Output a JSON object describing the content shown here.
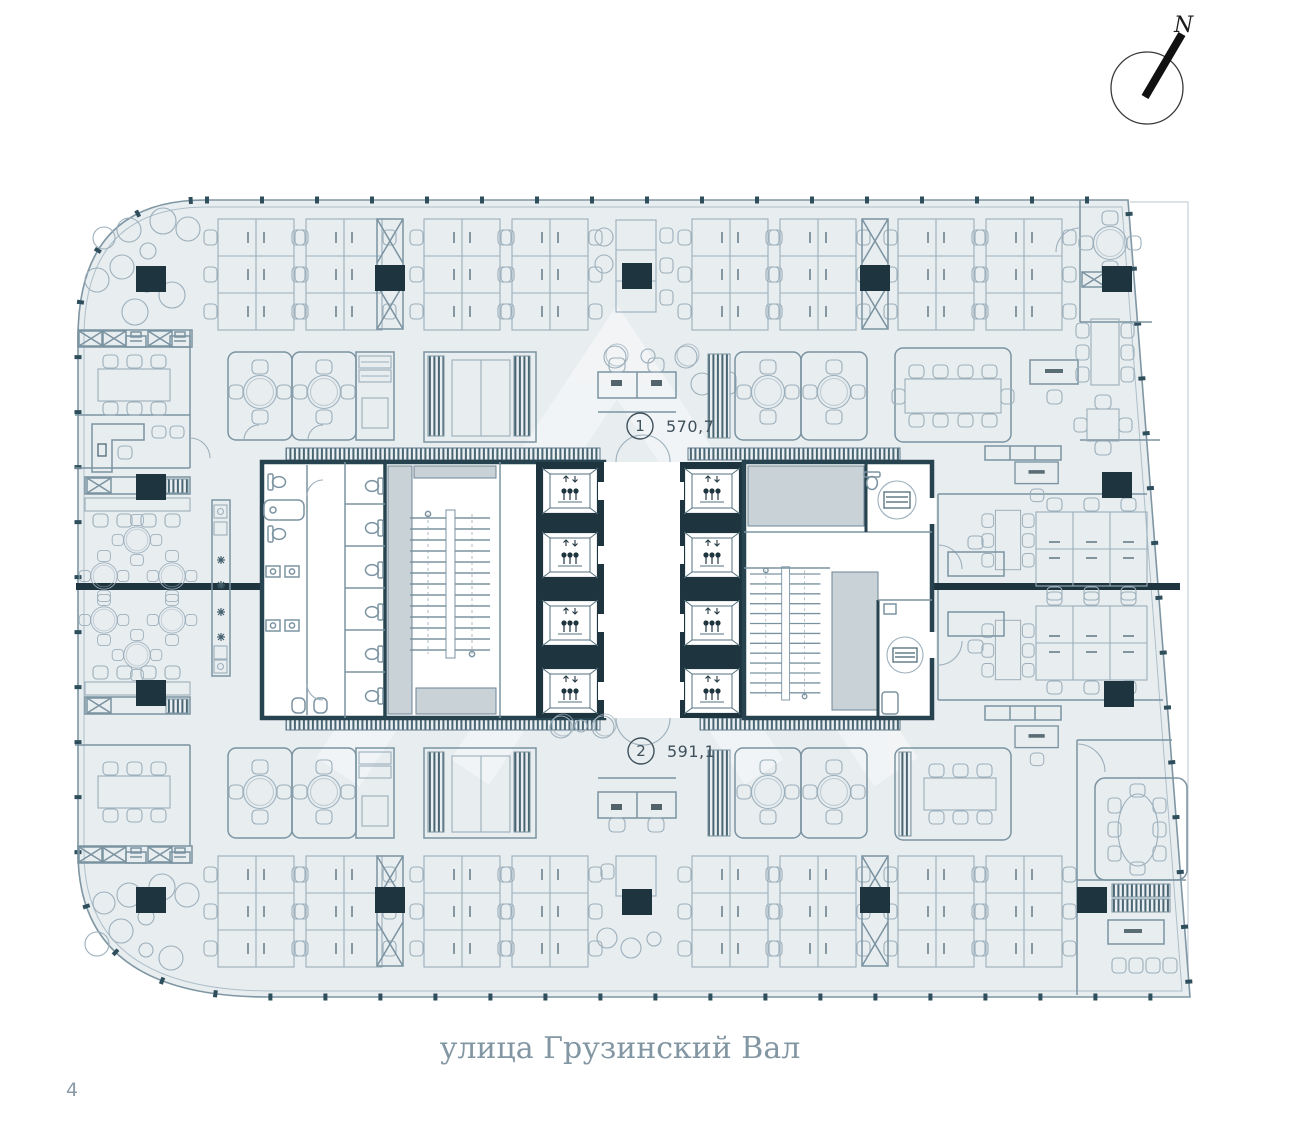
{
  "page": {
    "number": "4"
  },
  "compass": {
    "north_label": "N"
  },
  "plan": {
    "street_label": "улица Грузинский Вал",
    "units": [
      {
        "id": "1",
        "area": "570,7"
      },
      {
        "id": "2",
        "area": "591,1"
      }
    ]
  },
  "colors": {
    "plan_fill": "#e8edf0",
    "wall_dark": "#1e343e",
    "furniture_line": "#9cafbb",
    "label_text": "#3e505a",
    "street_text": "#8296a3"
  }
}
